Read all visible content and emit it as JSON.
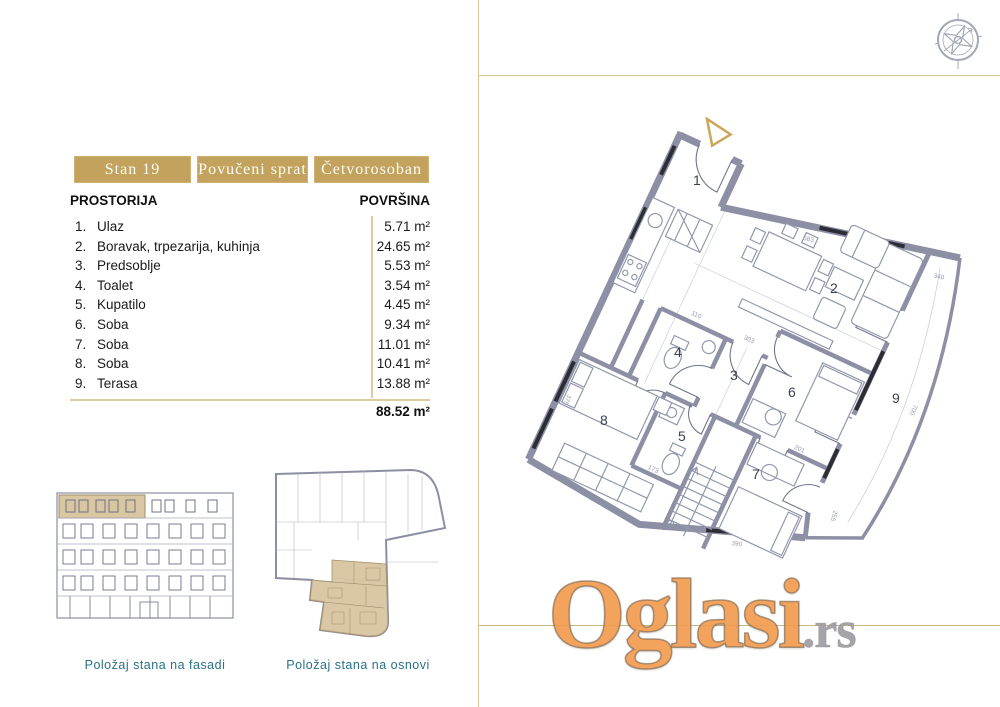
{
  "header": {
    "badges": [
      "Stan 19",
      "Povučeni sprat",
      "Četvorosoban"
    ]
  },
  "table": {
    "header_room": "PROSTORIJA",
    "header_area": "POVRŠINA",
    "rows": [
      {
        "num": "1.",
        "name": "Ulaz",
        "area": "5.71 m²"
      },
      {
        "num": "2.",
        "name": "Boravak, trpezarija, kuhinja",
        "area": "24.65 m²"
      },
      {
        "num": "3.",
        "name": "Predsoblje",
        "area": "5.53 m²"
      },
      {
        "num": "4.",
        "name": "Toalet",
        "area": "3.54 m²"
      },
      {
        "num": "5.",
        "name": "Kupatilo",
        "area": "4.45 m²"
      },
      {
        "num": "6.",
        "name": "Soba",
        "area": "9.34 m²"
      },
      {
        "num": "7.",
        "name": "Soba",
        "area": "11.01 m²"
      },
      {
        "num": "8.",
        "name": "Soba",
        "area": "10.41 m²"
      },
      {
        "num": "9.",
        "name": "Terasa",
        "area": "13.88 m²"
      }
    ],
    "total": "88.52 m²"
  },
  "captions": {
    "facade": "Položaj stana na fasadi",
    "inset": "Položaj stana na osnovi"
  },
  "plan": {
    "room_numbers": [
      "1",
      "2",
      "3",
      "4",
      "5",
      "6",
      "7",
      "8",
      "9"
    ],
    "dimension_labels": [
      "583",
      "340",
      "700",
      "303",
      "110",
      "173",
      "201",
      "390",
      "255",
      "375"
    ]
  },
  "watermark": {
    "brand": "Oglasi",
    "tld": ".rs"
  },
  "colors": {
    "badge_gold": "#c2a25c",
    "line_gold": "#d9c79c",
    "wall_gray": "#8d8fa5",
    "caption_teal": "#2b7086",
    "watermark_orange": "#f29c4e",
    "highlight_tan": "#d9c7a2"
  }
}
